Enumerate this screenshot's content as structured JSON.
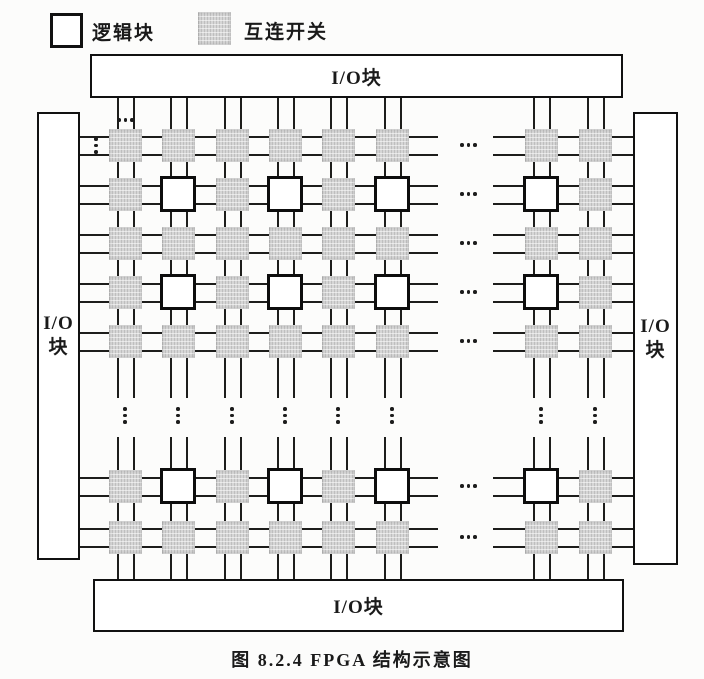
{
  "figure": {
    "caption": "图 8.2.4  FPGA 结构示意图"
  },
  "legend": {
    "logic_block_label": "逻辑块",
    "interconnect_switch_label": "互连开关"
  },
  "io": {
    "top": "I/O块",
    "bottom": "I/O块",
    "left": {
      "line1": "I/O",
      "line2": "块"
    },
    "right": {
      "line1": "I/O",
      "line2": "块"
    }
  },
  "grid": {
    "cell_types": {
      "S": "互连开关",
      "L": "逻辑块",
      "H": "横向省略号",
      "V": "纵向省略号"
    },
    "rows": [
      [
        "S",
        "S",
        "S",
        "S",
        "S",
        "S",
        "H",
        "S",
        "S"
      ],
      [
        "S",
        "L",
        "S",
        "L",
        "S",
        "L",
        "H",
        "L",
        "S"
      ],
      [
        "S",
        "S",
        "S",
        "S",
        "S",
        "S",
        "H",
        "S",
        "S"
      ],
      [
        "S",
        "L",
        "S",
        "L",
        "S",
        "L",
        "H",
        "L",
        "S"
      ],
      [
        "S",
        "S",
        "S",
        "S",
        "S",
        "S",
        "H",
        "S",
        "S"
      ],
      [
        "V",
        "V",
        "V",
        "V",
        "V",
        "V",
        "",
        "V",
        "V"
      ],
      [
        "S",
        "L",
        "S",
        "L",
        "S",
        "L",
        "H",
        "L",
        "S"
      ],
      [
        "S",
        "S",
        "S",
        "S",
        "S",
        "S",
        "H",
        "S",
        "S"
      ]
    ],
    "corner_marks": [
      "H",
      "V"
    ]
  },
  "colors": {
    "line": "#1d1d1b",
    "switch_fill": "#d6d6d6",
    "background": "#fcfcfb",
    "text": "#1a1a1a"
  }
}
